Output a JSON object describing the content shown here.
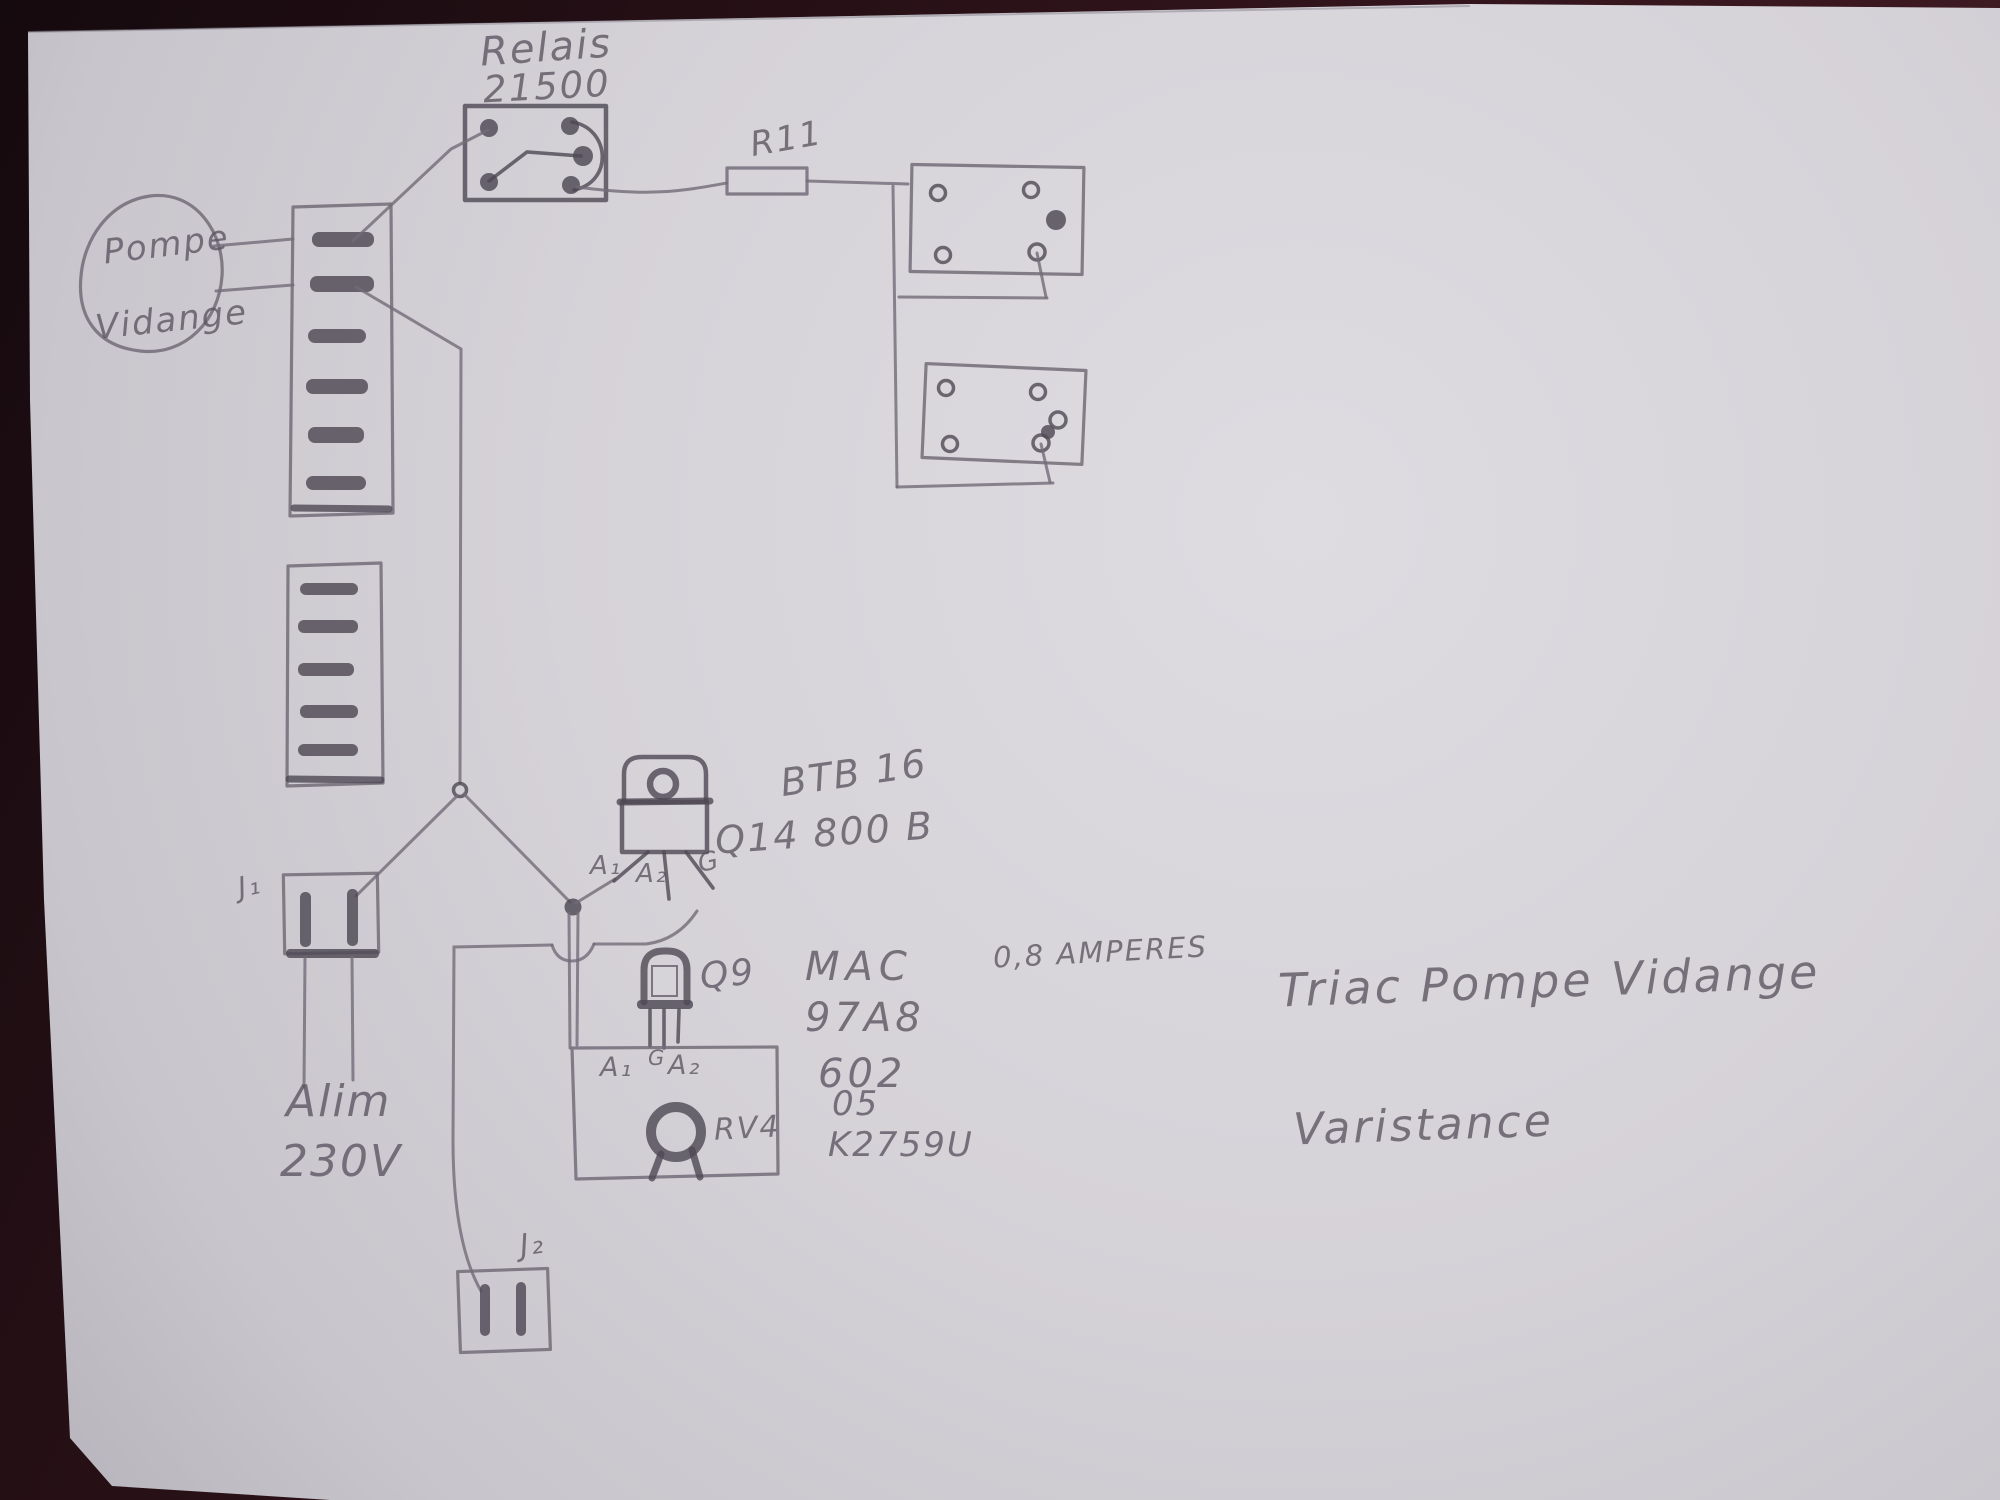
{
  "colors": {
    "bg_color": "#2a1016",
    "paper_color": "#d3d0d6",
    "pencil_color": "#726c78",
    "pencil_dark_color": "#4e4954",
    "ink_color": "#5a5460"
  },
  "labels": {
    "relay_name": "Relais",
    "relay_model": "21500",
    "pump_line1": "Pompe",
    "pump_line2": "Vidange",
    "resistor_ref": "R11",
    "triac_part": "BTB 16",
    "triac_ref_value": "Q14 800 B",
    "triac_pin_a1": "A₁",
    "triac_pin_a2": "A₂",
    "triac_pin_g": "G",
    "driver_ref": "Q9",
    "driver_part_line1": "MAC",
    "driver_part_line2": "97A8",
    "driver_part_line3": "602",
    "driver_pin_a1": "A₁",
    "driver_pin_g": "G",
    "driver_pin_a2": "A₂",
    "varistor_ref": "RV4",
    "varistor_part_line1": "05",
    "varistor_part_line2": "K2759U",
    "current_note": "0,8 AMPERES",
    "note_triac": "Triac Pompe Vidange",
    "note_varistance": "Varistance",
    "supply_line1": "Alim",
    "supply_line2": "230V",
    "connector_j1": "J₁",
    "connector_j2": "J₂"
  }
}
